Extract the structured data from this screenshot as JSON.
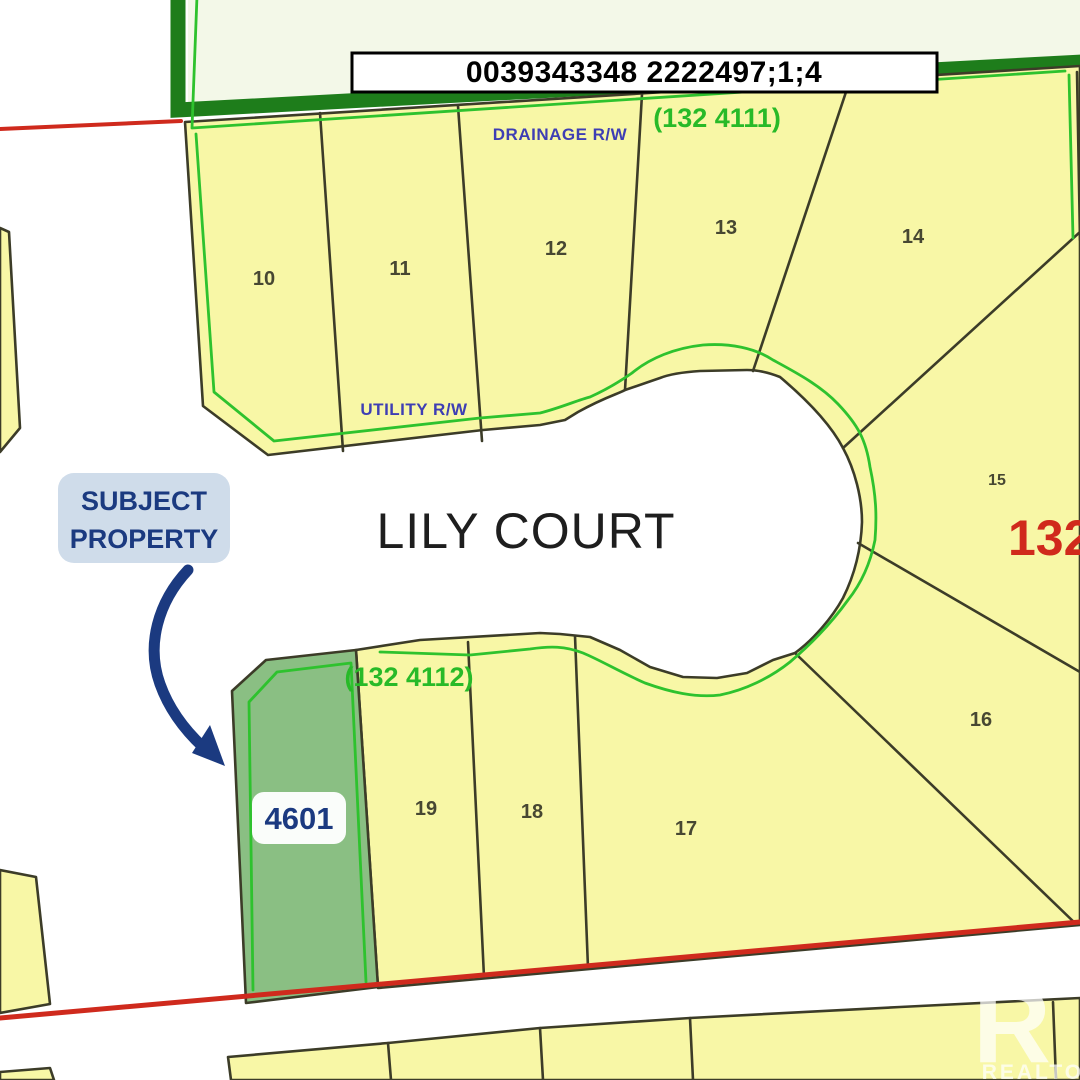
{
  "title_bar": {
    "text": "0039343348 2222497;1;4"
  },
  "street": {
    "name": "LILY COURT"
  },
  "easements": {
    "drainage": "DRAINAGE R/W",
    "utility": "UTILITY R/W"
  },
  "plans": {
    "upper": "(132 4111)",
    "lower": "(132 4112)",
    "block": "132"
  },
  "lots": [
    {
      "number": "10"
    },
    {
      "number": "11"
    },
    {
      "number": "12"
    },
    {
      "number": "13"
    },
    {
      "number": "14"
    },
    {
      "number": "15"
    },
    {
      "number": "16"
    },
    {
      "number": "17"
    },
    {
      "number": "18"
    },
    {
      "number": "19"
    }
  ],
  "subject_property": {
    "callout_line1": "SUBJECT",
    "callout_line2": "PROPERTY",
    "lot_number": "4601"
  },
  "watermark": {
    "logo_letter": "R",
    "label": "REALTOR"
  },
  "colors": {
    "lot-yellow": "#f8f7a6",
    "subject-green": "#8abf83",
    "bright-green": "#2ec22e",
    "band-green": "#1e7d1b",
    "red": "#cf2a1d",
    "blue": "#3e3eb4",
    "navy": "#1b3a80",
    "badge-bg": "#cfdcea"
  }
}
